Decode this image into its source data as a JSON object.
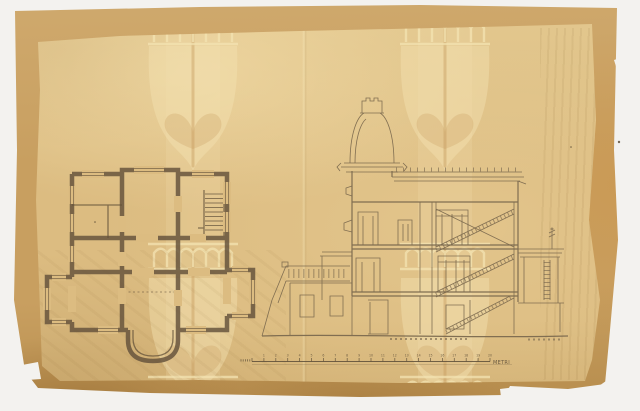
{
  "document": {
    "kind": "scanned architectural drawing",
    "views": {
      "left": "ground-floor-plan",
      "right": "transverse-section"
    }
  },
  "scale_bar": {
    "unit_label": "METRI",
    "tick_labels": [
      "1",
      "2",
      "3",
      "4",
      "5",
      "6",
      "7",
      "8",
      "9",
      "10",
      "11",
      "12",
      "13",
      "14",
      "15",
      "16",
      "17",
      "18",
      "19",
      "20"
    ],
    "minor_ticks_left": 5
  },
  "palette": {
    "backdrop": "#f3f2ef",
    "board": "#c89f60",
    "board_light": "#cfa96d",
    "board_dark": "#b68c4c",
    "sheet": "#dcbc81",
    "sheet_light": "#e3c88f",
    "sheet_shade": "#d2b175",
    "watermark_light": "#f3e3b2",
    "watermark_dark": "#c49758",
    "ink_plan": "#63513a",
    "ink_section": "#7b694e",
    "ink_text": "#5d4e38",
    "speck": "#54452f"
  }
}
